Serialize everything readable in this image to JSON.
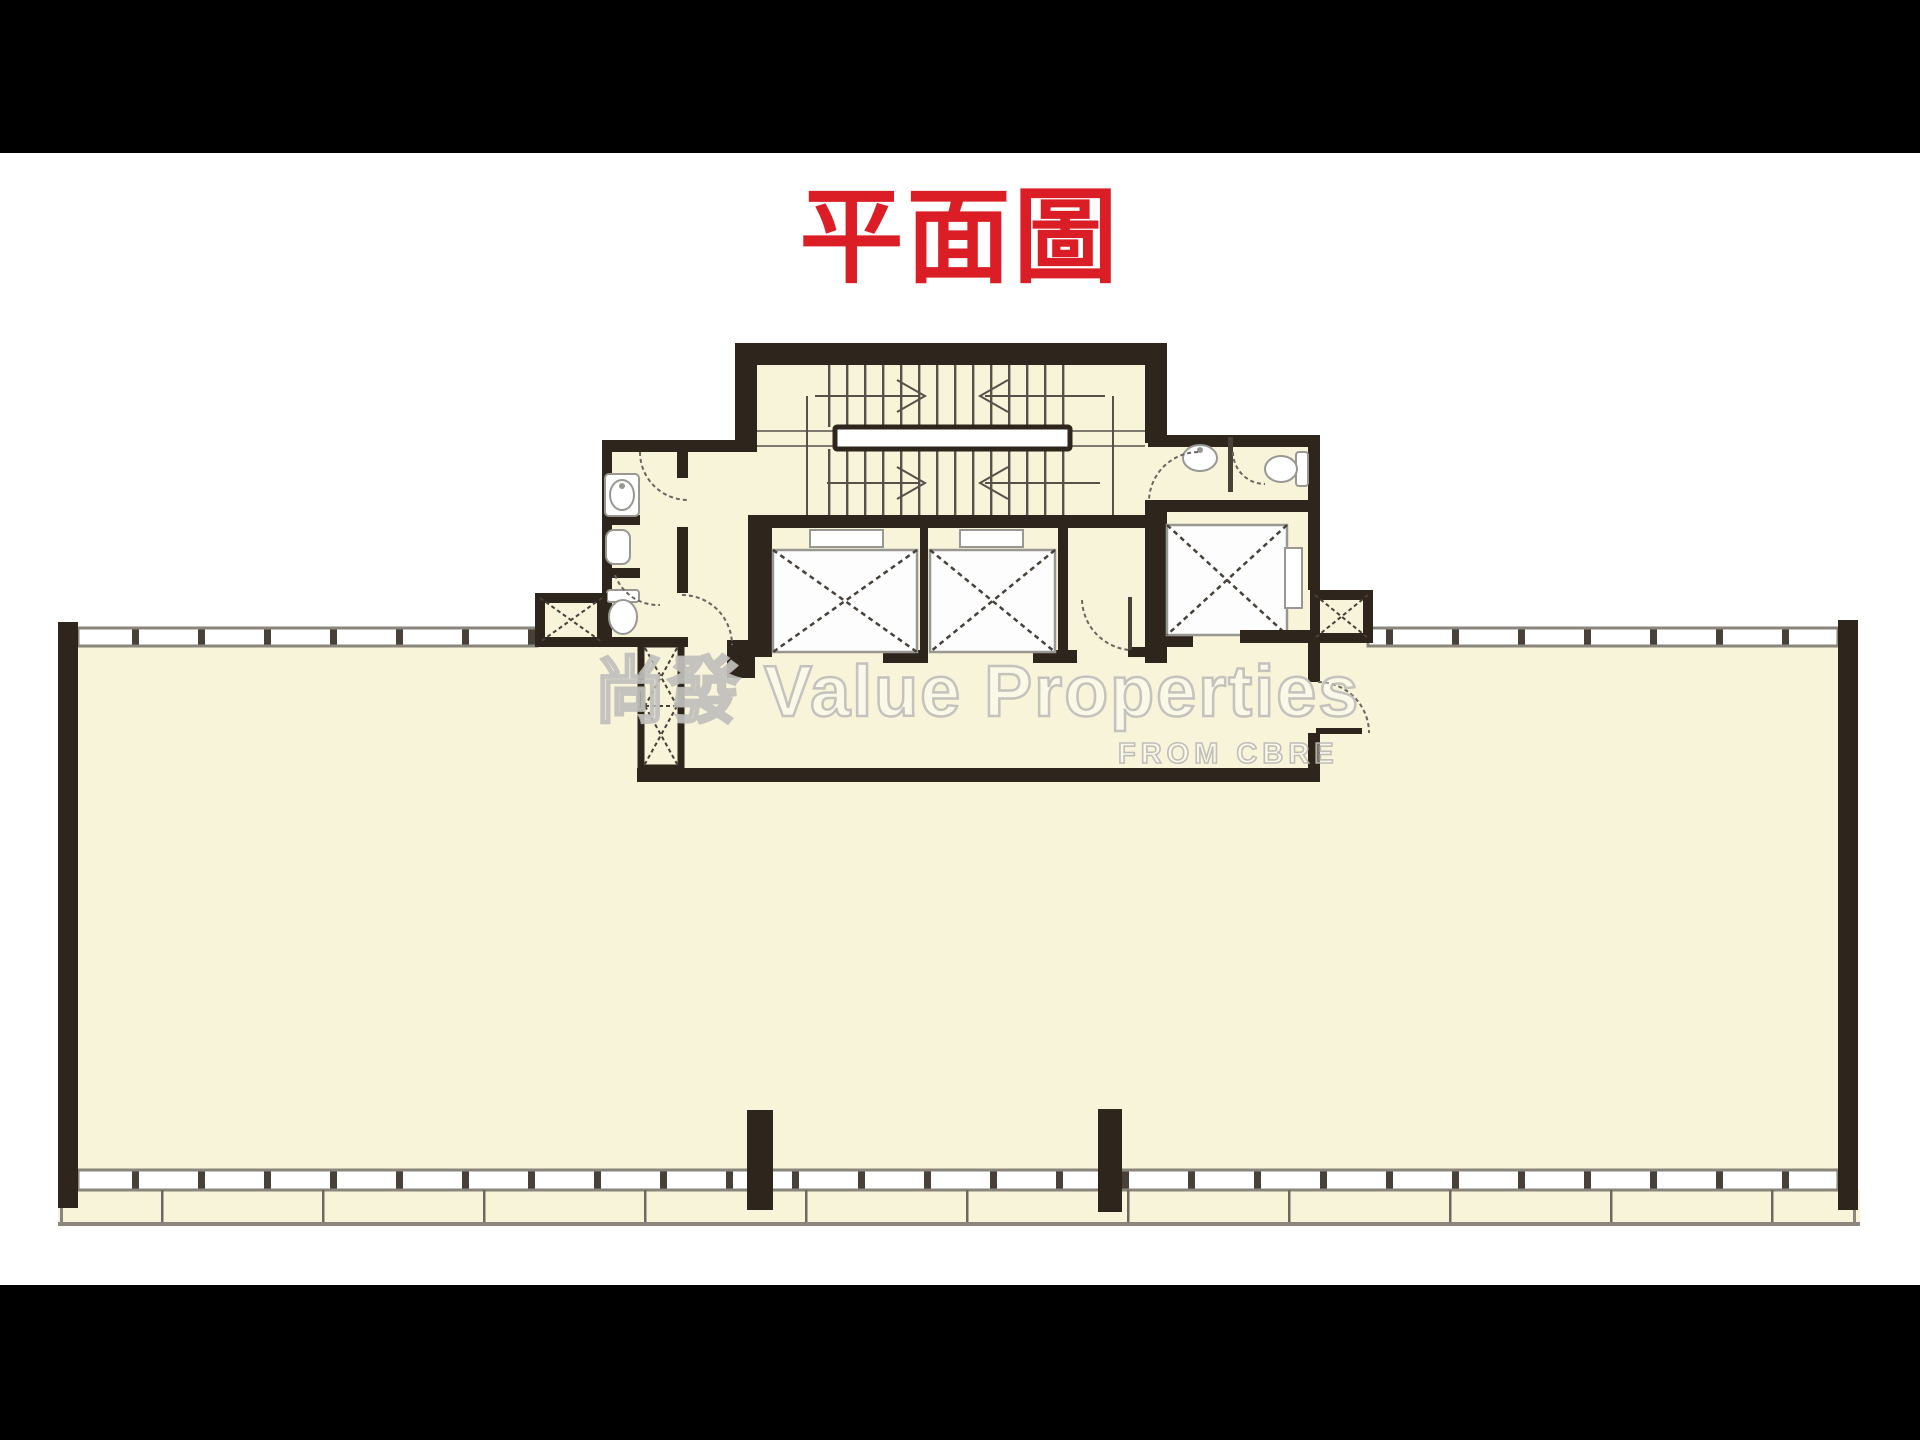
{
  "title": {
    "text": "平面圖"
  },
  "watermark": {
    "cjk": "尚發",
    "latin": "Value Properties",
    "subtext": "FROM CBRE"
  },
  "plan": {
    "colors": {
      "letterbox": "#000000",
      "background": "#FFFFFF",
      "floor": "#F8F4DA",
      "wall": "#2E251C",
      "band-line": "#8A867C",
      "thin-line": "#57514A",
      "hatch-line": "#47413A",
      "shaft-fill": "#FDFDFD",
      "fixture-line": "#999792",
      "title-red": "#DB1E25",
      "watermark-gray": "#BEBDB8"
    },
    "features": [
      "scissor-staircase",
      "stair-landing",
      "passenger-lift-1",
      "passenger-lift-2",
      "service-lift",
      "air-shaft-left",
      "air-shaft-right",
      "pipe-duct",
      "toilet-left",
      "toilet-right",
      "lift-lobby",
      "open-office-floor",
      "curtain-wall-window-band",
      "structural-column"
    ]
  }
}
